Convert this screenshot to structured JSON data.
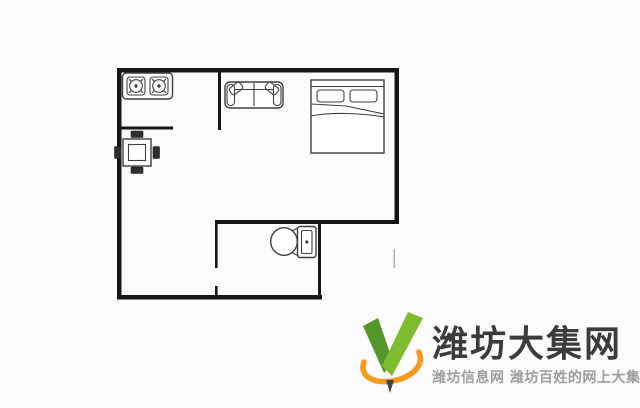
{
  "canvas": {
    "background": "#fbfbfb",
    "wall_color": "#161616",
    "furniture_line_color": "#3f3f3f"
  },
  "floorplan": {
    "description": "apartment-floor-plan",
    "furniture": [
      {
        "icon": "gas-stove-two-burner-icon",
        "area": "kitchen-top-left"
      },
      {
        "icon": "square-dining-table-four-chairs-icon",
        "area": "hall-left"
      },
      {
        "icon": "two-seat-sofa-icon",
        "area": "living-area-top-center"
      },
      {
        "icon": "double-bed-icon",
        "area": "bedroom-area-top-right"
      },
      {
        "icon": "toilet-icon",
        "area": "bathroom-bottom-center"
      }
    ]
  },
  "watermark": {
    "logo_icon": "v-checkmark-swoosh-logo",
    "title": "潍坊大集网",
    "subtitle": "潍坊信息网 潍坊百姓的网上大集",
    "colors": {
      "green_dark": "#53972b",
      "green_light": "#7fbc30",
      "orange": "#f49b1f",
      "nib_dark": "#454545",
      "title_text": "#3b3b3b",
      "subtitle_text": "#9d9d9d"
    }
  }
}
